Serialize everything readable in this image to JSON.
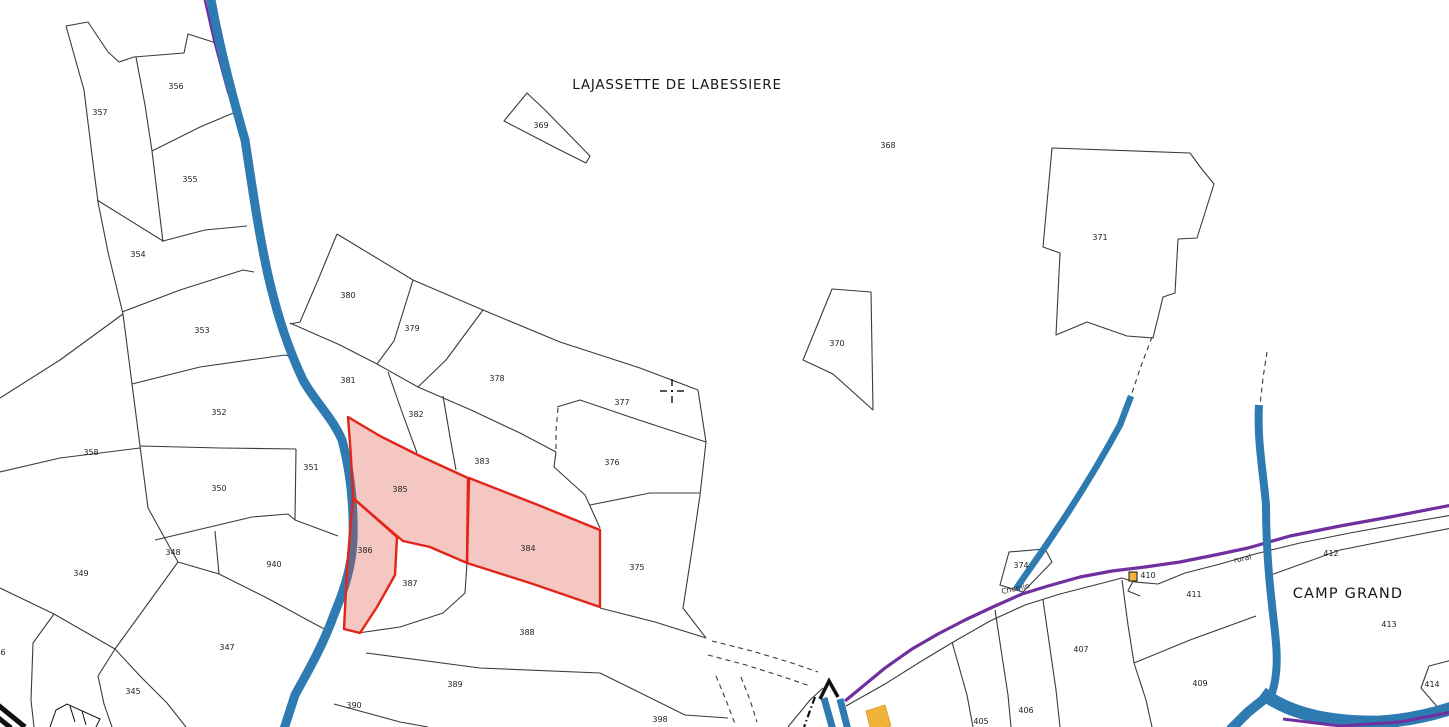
{
  "map": {
    "width": 1449,
    "height": 727,
    "colors": {
      "background": "#ffffff",
      "boundary": "#3b3b3b",
      "water": "#2e7bb1",
      "road": "#7030a0",
      "highlight_stroke": "#e1251b",
      "highlight_fill": "rgba(220,70,55,0.30)",
      "building": "#f2b33d",
      "label": "#1f1f1f"
    },
    "place_labels": [
      {
        "text": "LAJASSETTE DE LABESSIERE",
        "x": 677,
        "y": 89,
        "size": 13.5,
        "spacing": 0.8
      },
      {
        "text": "CAMP GRAND",
        "x": 1348,
        "y": 598,
        "size": 14.5,
        "spacing": 1.2
      }
    ],
    "road_labels": [
      {
        "text": "Chemin",
        "x": 1016,
        "y": 591,
        "angle": -12
      },
      {
        "text": "rural",
        "x": 1243,
        "y": 561,
        "angle": -12
      }
    ],
    "selected_parcels": [
      "385",
      "384",
      "386"
    ],
    "parcel_labels": [
      {
        "text": "357",
        "x": 100,
        "y": 115
      },
      {
        "text": "356",
        "x": 176,
        "y": 89
      },
      {
        "text": "355",
        "x": 190,
        "y": 182
      },
      {
        "text": "354",
        "x": 138,
        "y": 257
      },
      {
        "text": "353",
        "x": 202,
        "y": 333
      },
      {
        "text": "352",
        "x": 219,
        "y": 415
      },
      {
        "text": "358",
        "x": 91,
        "y": 455
      },
      {
        "text": "350",
        "x": 219,
        "y": 491
      },
      {
        "text": "351",
        "x": 311,
        "y": 470
      },
      {
        "text": "348",
        "x": 173,
        "y": 555
      },
      {
        "text": "349",
        "x": 81,
        "y": 576
      },
      {
        "text": "940",
        "x": 274,
        "y": 567
      },
      {
        "text": "347",
        "x": 227,
        "y": 650
      },
      {
        "text": "345",
        "x": 133,
        "y": 694
      },
      {
        "text": "346",
        "x": -2,
        "y": 655
      },
      {
        "text": "390",
        "x": 354,
        "y": 708
      },
      {
        "text": "389",
        "x": 455,
        "y": 687
      },
      {
        "text": "388",
        "x": 527,
        "y": 635
      },
      {
        "text": "398",
        "x": 660,
        "y": 722
      },
      {
        "text": "387",
        "x": 410,
        "y": 586
      },
      {
        "text": "385",
        "x": 400,
        "y": 492
      },
      {
        "text": "386",
        "x": 365,
        "y": 553
      },
      {
        "text": "384",
        "x": 528,
        "y": 551
      },
      {
        "text": "375",
        "x": 637,
        "y": 570
      },
      {
        "text": "376",
        "x": 612,
        "y": 465
      },
      {
        "text": "383",
        "x": 482,
        "y": 464
      },
      {
        "text": "382",
        "x": 416,
        "y": 417
      },
      {
        "text": "381",
        "x": 348,
        "y": 383
      },
      {
        "text": "380",
        "x": 348,
        "y": 298
      },
      {
        "text": "379",
        "x": 412,
        "y": 331
      },
      {
        "text": "378",
        "x": 497,
        "y": 381
      },
      {
        "text": "377",
        "x": 622,
        "y": 405
      },
      {
        "text": "369",
        "x": 541,
        "y": 128
      },
      {
        "text": "368",
        "x": 888,
        "y": 148
      },
      {
        "text": "370",
        "x": 837,
        "y": 346
      },
      {
        "text": "371",
        "x": 1100,
        "y": 240
      },
      {
        "text": "374",
        "x": 1021,
        "y": 568
      },
      {
        "text": "410",
        "x": 1148,
        "y": 578
      },
      {
        "text": "411",
        "x": 1194,
        "y": 597
      },
      {
        "text": "412",
        "x": 1331,
        "y": 556
      },
      {
        "text": "413",
        "x": 1389,
        "y": 627
      },
      {
        "text": "414",
        "x": 1432,
        "y": 687
      },
      {
        "text": "409",
        "x": 1200,
        "y": 686
      },
      {
        "text": "407",
        "x": 1081,
        "y": 652
      },
      {
        "text": "406",
        "x": 1026,
        "y": 713
      },
      {
        "text": "405",
        "x": 981,
        "y": 724
      }
    ],
    "geometry": {
      "boundaries": [
        "M 66 26 L 88 22 L 108 52 L 119 62 L 134 57 L 184 53 L 188 34 L 216 43",
        "M 66 26 L 84 90 L 92 155 L 98 202 L 108 252 L 123 314 L 132 384 L 140 446 L 148 508 L 178 562",
        "M 136 57 L 145 105 L 152 151",
        "M 152 151 L 200 127 L 238 111",
        "M 152 151 L 163 242",
        "M 97 200 L 163 241",
        "M 163 241 L 205 230 L 247 226",
        "M 122 312 L 180 290 L 243 270 L 254 272",
        "M 132 384 L 200 367 L 285 355 L 296 358",
        "M 140 446 L 220 448 L 296 449",
        "M 296 449 L 295 520",
        "M 295 520 L 338 536",
        "M 0 472 L 60 458 L 140 448",
        "M 123 314 L 60 360 L 0 398",
        "M 155 540 L 252 517 L 288 514 L 295 520",
        "M 215 531 L 219 574",
        "M 178 562 L 219 574",
        "M 219 574 L 267 598 L 313 623 L 330 632",
        "M 178 562 L 115 649",
        "M 0 588 L 54 614 L 115 649",
        "M 54 614 L 33 643 L 31 700 L 34 727",
        "M 115 649 L 98 676 L 104 704 L 112 727",
        "M 115 649 L 141 677 L 167 703 L 186 727",
        "M 337 234 L 413 280 L 483 310 L 560 342 L 640 368 L 698 390",
        "M 337 234 L 318 280 L 300 322 L 290 324",
        "M 413 280 L 394 341 L 377 364",
        "M 483 310 L 446 360 L 418 387",
        "M 290 323 L 340 345 L 377 364 L 418 387 L 471 410 L 520 433 L 556 452",
        "M 556 452 L 554 467 L 585 495 L 600 528",
        "M 388 372 L 402 412 L 417 453",
        "M 443 396 L 450 437 L 456 470",
        "M 557 407 L 580 400 L 630 417 L 706 442",
        "M 698 390 L 706 442 L 700 495 L 692 550 L 683 608 L 706 638",
        "M 590 505 L 650 493 L 700 493",
        "M 600 608 L 655 622 L 706 638",
        "M 467 563 L 465 593 L 443 613 L 400 627 L 358 633",
        "M 366 653 L 480 668 L 600 673 L 685 715 L 728 718",
        "M 334 704 L 400 722 L 428 727",
        "M 788 727 L 810 700 L 823 688",
        "M 846 706 L 885 684 L 920 662 L 955 641 L 990 621 L 1025 605 L 1060 594 L 1095 585 L 1122 578 L 1135 582 L 1158 584 L 1185 573 L 1220 564 L 1255 554 L 1300 543 L 1350 533 L 1400 524 L 1452 515",
        "M 952 642 L 967 695 L 973 727",
        "M 995 610 L 1008 695 L 1011 727",
        "M 1043 600 L 1056 690 L 1060 727",
        "M 1122 580 L 1128 625 L 1134 663 L 1146 700 L 1152 727",
        "M 1134 663 L 1190 640 L 1256 616",
        "M 1268 576 L 1340 550 L 1400 538 L 1452 528",
        "M 1429 666 L 1452 660",
        "M 1429 666 L 1421 688 L 1440 710",
        "M 1133 581 L 1128 591 L 1140 596",
        "M 1052 148 L 1043 247 L 1060 253 L 1056 335 L 1087 322 L 1127 336 L 1153 338 L 1163 297 L 1175 293 L 1178 239 L 1197 238 L 1214 184 L 1201 168 L 1190 153 Z",
        "M 832 289 L 871 292 L 873 410 L 833 374 L 803 360 Z",
        "M 527 93 L 504 121 L 558 149 L 586 163 L 590 156 L 546 111 Z"
      ],
      "dashed": [
        "M 1152 337 L 1141 366 L 1131 396",
        "M 1267 352 L 1263 378 L 1260 405",
        "M 558 408 L 556 430 L 556 452",
        "M 712 641 L 752 651 L 792 663 L 818 672",
        "M 708 655 L 746 665 L 784 677 L 810 686",
        "M 716 676 L 726 700 L 735 724",
        "M 741 677 L 750 700 L 757 722"
      ],
      "dashdot": [
        "M 815 697 L 804 727"
      ],
      "roads": {
        "main": "M 845 701 L 862 687 L 885 668 L 912 649 L 938 634 L 965 620 L 995 606 L 1022 594 L 1048 586 L 1080 577 L 1112 571 L 1145 567 L 1180 562 L 1215 555 L 1248 548 L 1290 536 L 1340 526 L 1390 517 L 1452 505",
        "river_edge": "M 204 -4 L 214 40 L 228 92 L 242 128",
        "bottom": "M 1283 719 L 1340 726 L 1400 722 L 1452 712"
      },
      "waterways": [
        {
          "d": "M 210 -6 C 218 40 232 95 245 140 C 252 185 258 230 268 275 C 278 318 288 348 303 380 C 316 403 332 417 342 440 C 350 470 354 505 353 540 C 352 565 345 588 335 612 C 324 643 310 668 295 695 L 283 732",
          "w": 9
        },
        {
          "d": "M 1131 396 L 1120 425 C 1100 462 1080 495 1055 532 C 1040 555 1025 575 1016 589",
          "w": 6.5
        },
        {
          "d": "M 1259 405 C 1257 440 1263 470 1266 505 C 1266 540 1268 570 1272 605 C 1275 635 1281 665 1272 693 L 1268 700",
          "w": 8
        },
        {
          "d": "M 1268 696 L 1248 712 L 1230 730",
          "w": 10
        },
        {
          "d": "M 1262 693 C 1290 714 1330 723 1380 722 C 1410 720 1435 714 1455 707",
          "w": 13
        },
        {
          "d": "M 824 698 L 833 730",
          "w": 7
        },
        {
          "d": "M 840 699 L 848 730",
          "w": 7
        }
      ],
      "white_parcels": [
        "1000,585 1009,552 1045,549 1052,562 1023,592"
      ],
      "buildings": [
        "866,711 885,705 891,726 871,731"
      ],
      "building_icon": {
        "x": 1129,
        "y": 572,
        "w": 8,
        "h": 9
      },
      "marks": [
        {
          "d": "M 820 699 L 829 681 L 838 697",
          "w": 3.5
        },
        {
          "d": "M -2 705 L 25 727",
          "w": 5
        },
        {
          "d": "M -4 716 L 11 728",
          "w": 5
        },
        {
          "d": "M 50 727 L 56 710 L 67 704 L 100 719 L 96 727",
          "w": 1
        },
        {
          "d": "M 70 706 L 75 722",
          "w": 1
        },
        {
          "d": "M 82 711 L 86 725",
          "w": 1
        }
      ],
      "highlights": [
        {
          "id": "385",
          "points": "348,417 380,436 420,456 468,478 467,563 430,547 403,541 397,536 353,498 351,457"
        },
        {
          "id": "384",
          "points": "469,478 533,503 600,530 600,607 533,584 467,563"
        },
        {
          "id": "386",
          "points": "353,498 397,537 395,575 377,607 360,633 344,629 347,570 351,520"
        }
      ]
    },
    "cursor": {
      "x": 672,
      "y": 391
    }
  }
}
